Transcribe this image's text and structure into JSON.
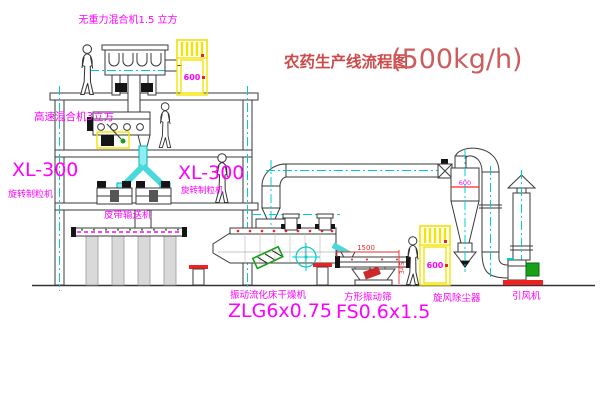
{
  "title": {
    "main": "农药生产线流程图",
    "capacity": "(500kg/h)"
  },
  "labels": {
    "gravity_mixer": "无重力混合机1.5 立方",
    "high_speed_mixer": "高速混合机3立方",
    "granulator_model_1": "XL-300",
    "granulator_name_1": "旋转制粒机",
    "granulator_model_2": "XL-300",
    "granulator_name_2": "旋转制粒机",
    "belt_conveyor": "皮带输送机",
    "fluid_bed_dryer": "振动流化床干燥机",
    "fluid_bed_model": "ZLG6x0.75",
    "square_sieve": "方形振动筛",
    "square_sieve_model": "FS0.6x1.5",
    "cyclone": "旋风除尘器",
    "induced_fan": "引风机"
  },
  "annotations": {
    "elevator_1_size": "600",
    "elevator_2_size": "600",
    "cyclone_size": "600",
    "sieve_width_dim": "1500",
    "sieve_height_dim": "345"
  },
  "colors": {
    "label_magenta": "#ff00ff",
    "title_red": "#cd4a4a",
    "centerline_cyan": "#00cccc",
    "equipment_yellow": "#f2e400",
    "accent_red": "#ef2020",
    "accent_green": "#18a018"
  }
}
